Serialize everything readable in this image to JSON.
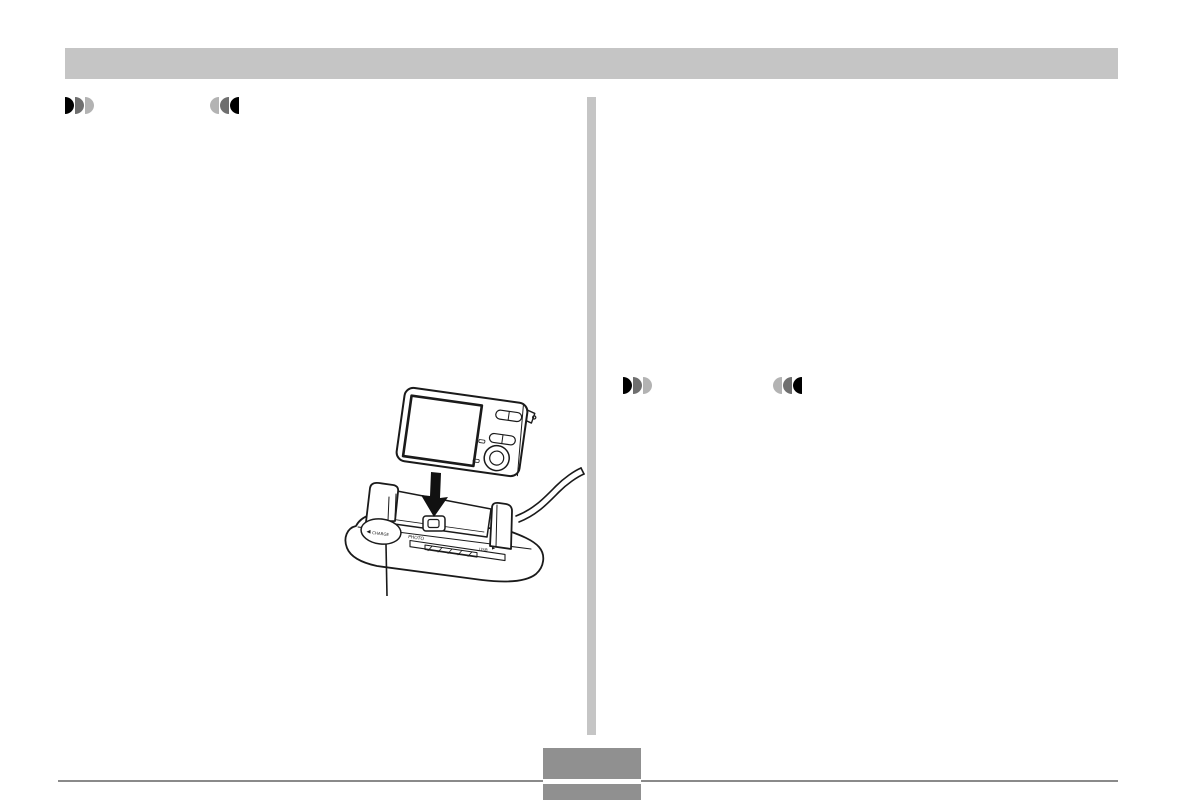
{
  "colors": {
    "page_background": "#ffffff",
    "header_bar": "#c5c5c5",
    "column_divider": "#c5c5c5",
    "footer_rule": "#8a8a8a",
    "page_number_box": "#909090",
    "line_art": "#1a1a1a",
    "marker_dark": "#000000",
    "marker_mid": "#6f6f6f",
    "marker_light": "#b3b3b3"
  },
  "icons": {
    "section_marker_forward": "three right-half-discs, dark to light",
    "section_marker_back": "three left-half-discs, light to dark",
    "down_arrow": "solid black arrow pointing down into cradle"
  },
  "illustration": {
    "name": "camera-docking-into-usb-cradle",
    "labels": {
      "charge": "CHARGE",
      "photo": "PHOTO",
      "usb": "USB"
    }
  }
}
